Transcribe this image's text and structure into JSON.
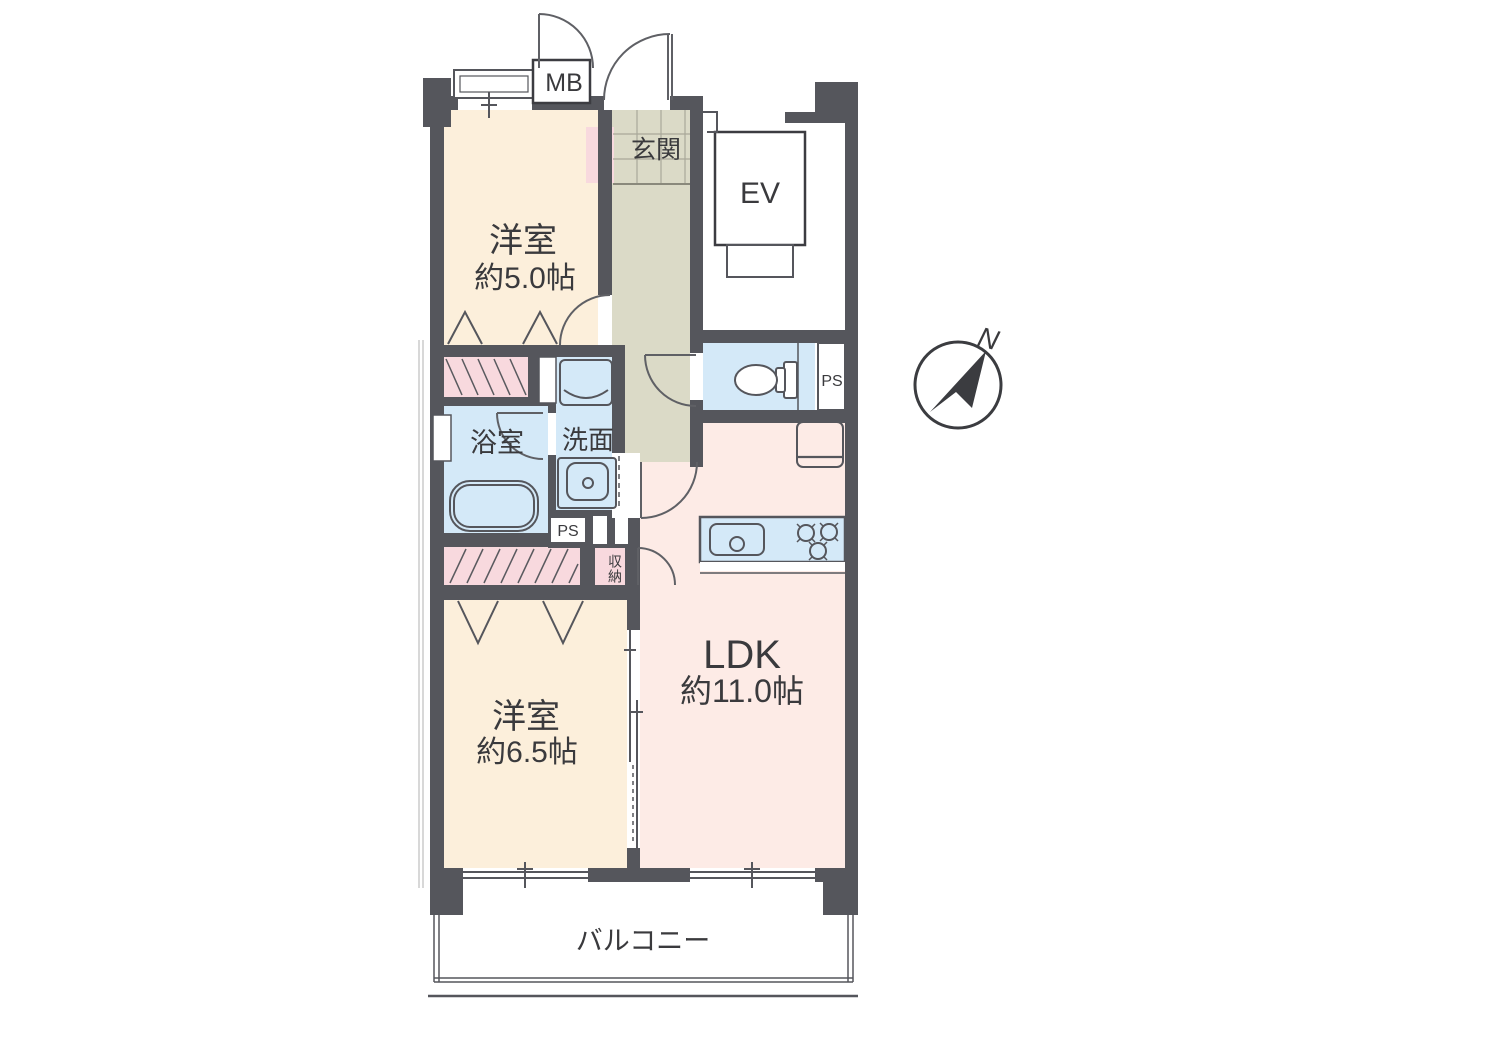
{
  "floor_plan": {
    "bedroom_5": {
      "name": "洋室",
      "size": "約5.0帖"
    },
    "bedroom_65": {
      "name": "洋室",
      "size": "約6.5帖"
    },
    "ldk": {
      "name": "LDK",
      "size": "約11.0帖"
    },
    "entrance_label": "玄関",
    "bathroom_label": "浴室",
    "washroom_label": "洗面",
    "storage_label": "収納",
    "balcony_label": "バルコニー",
    "meter_box_label": "MB",
    "elevator_label": "EV",
    "pipe_space_toilet": "PS",
    "pipe_space_washroom": "PS",
    "compass_north": "N"
  },
  "colors": {
    "wall": "#55565c",
    "western_room_floor": "#fcefdb",
    "ldk_floor": "#fdebe6",
    "wet_area_floor": "#d4e9f8",
    "entrance_hall_floor": "#dbdac7",
    "closet_fill": "#f8d9de",
    "background": "#ffffff"
  }
}
